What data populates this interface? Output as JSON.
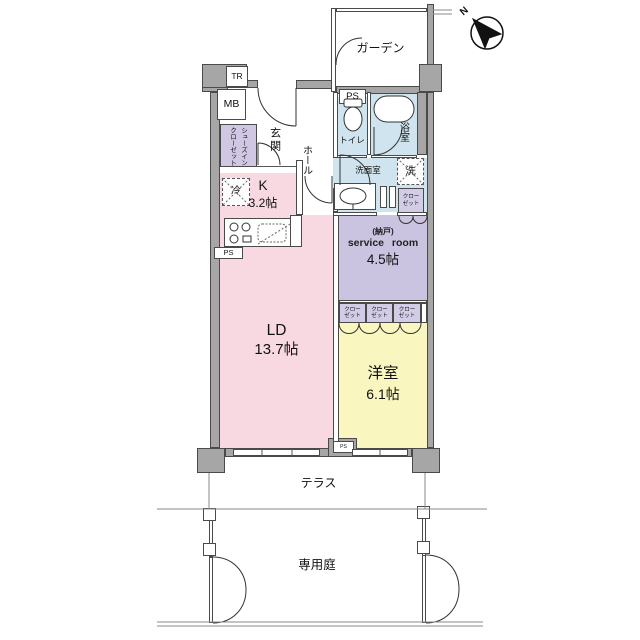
{
  "compass": {
    "north": "N"
  },
  "rooms": {
    "garden": {
      "label": "ガーデン"
    },
    "genkan": {
      "label": "玄関"
    },
    "hall": {
      "label": "ホール"
    },
    "toilet": {
      "label": "トイレ"
    },
    "bath": {
      "label": "浴室"
    },
    "washroom": {
      "label": "洗面室"
    },
    "kitchen": {
      "label": "K",
      "size": "3.2帖"
    },
    "living_dining": {
      "label": "LD",
      "size": "13.7帖"
    },
    "service_room": {
      "label_sub": "(納戸)",
      "label": "service room",
      "size": "4.5帖"
    },
    "western_room": {
      "label": "洋室",
      "size": "6.1帖"
    },
    "terrace": {
      "label": "テラス"
    },
    "private_garden": {
      "label": "専用庭"
    }
  },
  "fixtures": {
    "trunk_room": "TR",
    "meter_box": "MB",
    "pipe_space": "PS",
    "washer": "洗",
    "fridge": "冷",
    "shoes_closet": {
      "line1": "シューズイン",
      "line2": "クローゼット"
    },
    "closet": {
      "line1": "クロー",
      "line2": "ゼット"
    }
  },
  "colors": {
    "wall": "#a6a6a6",
    "ld_kitchen": "#f8d9e2",
    "western_room": "#f9f6c0",
    "service_room": "#cbc4e0",
    "wet_area": "#cfe4ee",
    "closet": "#d3cce7"
  }
}
